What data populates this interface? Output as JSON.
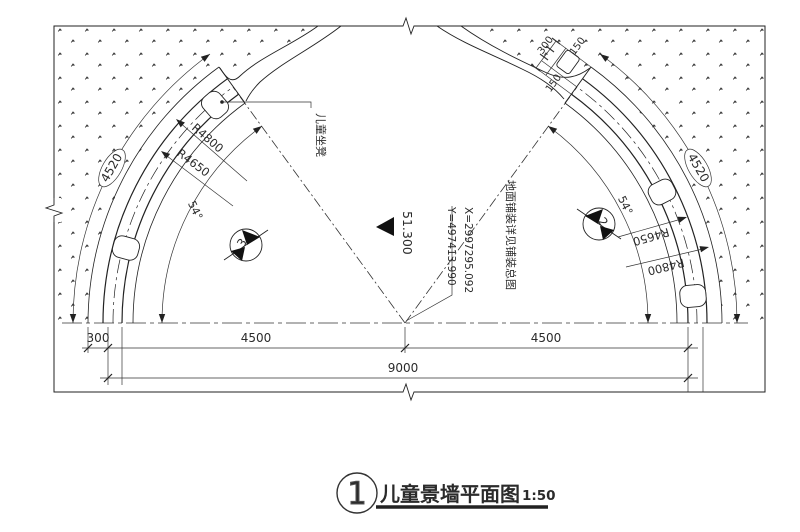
{
  "title_block": {
    "detail_number": "1",
    "title": "儿童景墙平面图",
    "scale": "1:50"
  },
  "dims": {
    "bottom": {
      "d300": "300",
      "d4500_left": "4500",
      "d4500_right": "4500",
      "d9000": "9000"
    },
    "radii": {
      "left_outer": "R4800",
      "left_inner": "R4650",
      "right_outer": "R4800",
      "right_inner": "R4650"
    },
    "arc_lengths": {
      "left": "4520",
      "right": "4520"
    },
    "angles": {
      "left": "54°",
      "right": "54°"
    },
    "wall_end": {
      "d300": "300",
      "d150_a": "150",
      "d150_b": "150"
    }
  },
  "annotations": {
    "coordinate_x": "X=2997295.092",
    "coordinate_y": "Y=497413.990",
    "elevation": "51.300",
    "paving_note": "地面铺装详见铺装总图",
    "bench_label": "儿童坐凳"
  },
  "sections": {
    "left_number": "3",
    "right_number": "2"
  }
}
